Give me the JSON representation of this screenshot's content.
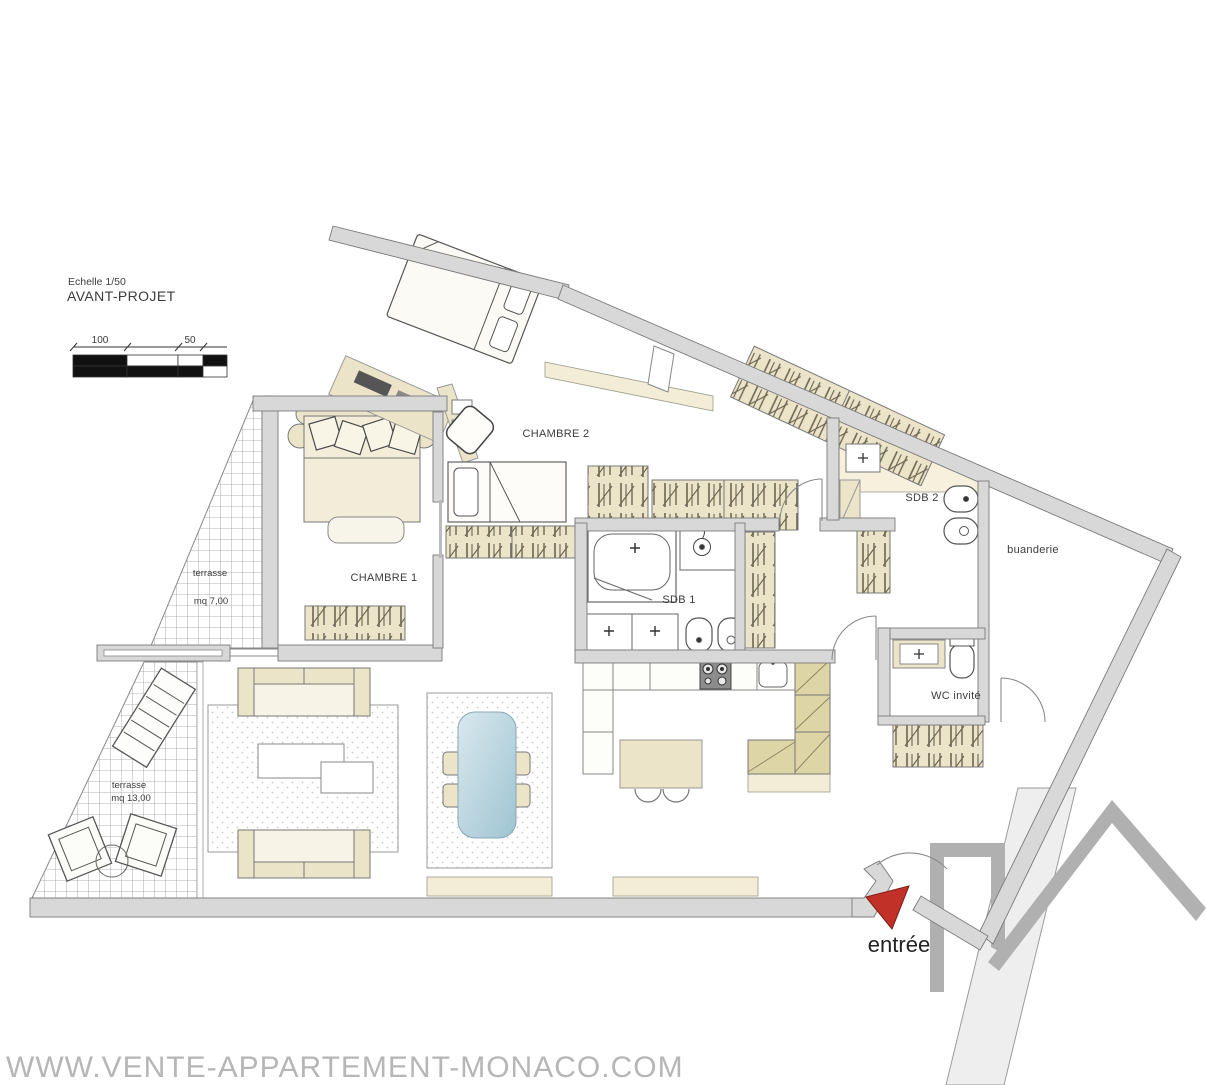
{
  "header": {
    "scale_note": "Echelle 1/50",
    "project_title": "AVANT-PROJET"
  },
  "scale_bar": {
    "label_100": "100",
    "label_50": "50"
  },
  "rooms": {
    "chambre1": {
      "label": "CHAMBRE 1"
    },
    "chambre2": {
      "label": "CHAMBRE 2"
    },
    "sdb1": {
      "label": "SDB 1"
    },
    "sdb2": {
      "label": "SDB 2"
    },
    "buanderie": {
      "label": "buanderie"
    },
    "wc_invite": {
      "label": "WC invité"
    },
    "terrasse_haut": {
      "label": "terrasse",
      "area": "mq 7,00"
    },
    "terrasse_bas": {
      "label": "terrasse",
      "area": "mq 13,00"
    },
    "entree": {
      "label": "entrée"
    }
  },
  "watermark": {
    "text": "WWW.VENTE-APPARTEMENT-MONACO.COM"
  },
  "colors": {
    "wall_fill": "#d8d8d8",
    "wall_stroke": "#7a7a7a",
    "furniture_cream": "#ece4c9",
    "cabinet_olive": "#ded5a6",
    "dining_table_blue": "#b9d4de",
    "entry_arrow_red": "#c23127",
    "watermark_gray": "#b6b6b6",
    "logo_gray": "#a3a3a3"
  }
}
